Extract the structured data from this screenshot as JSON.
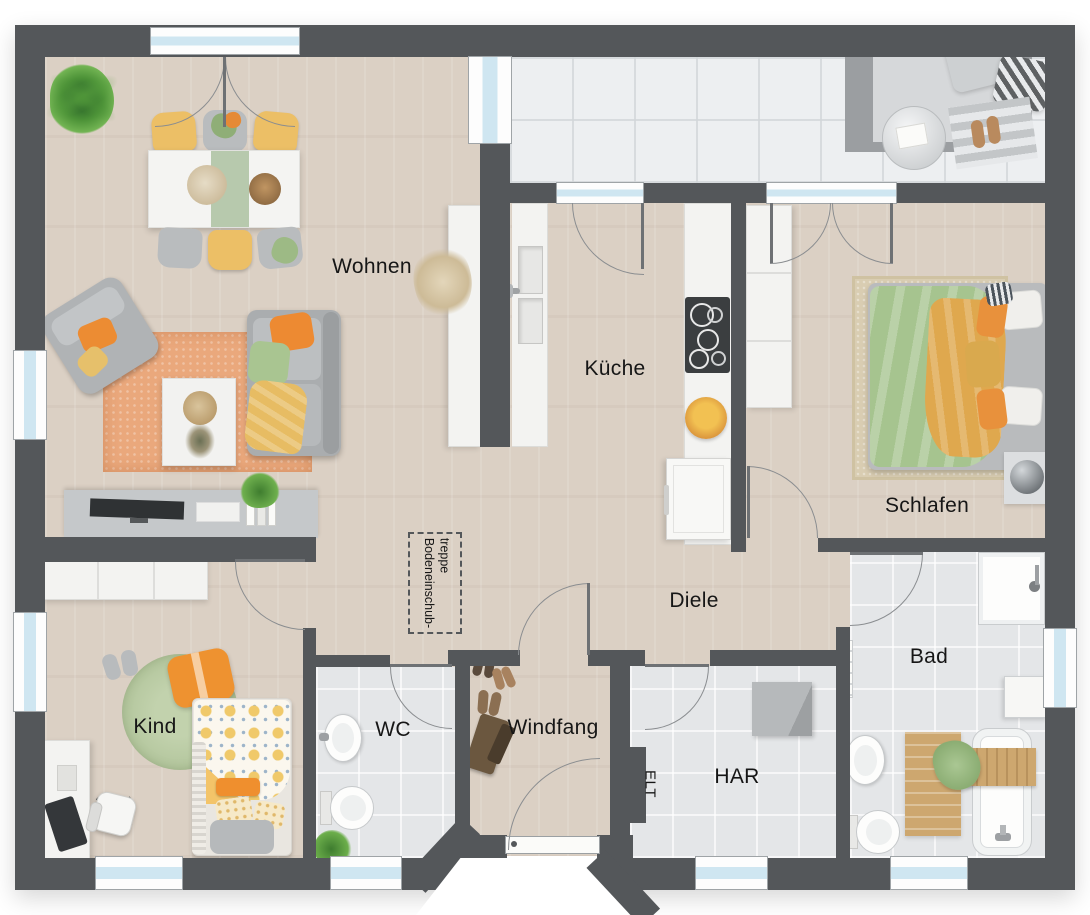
{
  "rooms": {
    "wohnen": "Wohnen",
    "kueche": "Küche",
    "schlafen": "Schlafen",
    "diele": "Diele",
    "kind": "Kind",
    "wc": "WC",
    "windfang": "Windfang",
    "har": "HAR",
    "bad": "Bad"
  },
  "annotations": {
    "electrical": "ELT",
    "attic_stairs_line1": "Bodeneinschub-",
    "attic_stairs_line2": "treppe"
  },
  "palette": {
    "wall": "#54575a",
    "wood_floor": "#dbd0c4",
    "tile_floor": "#e4e6e8",
    "terrace_floor": "#edeff1",
    "window_glass": "#cfe6f1",
    "accent_orange": "#ec8c33",
    "accent_yellow": "#ecbf66",
    "accent_green": "#a8c591",
    "rug_orange": "#eaa87c",
    "rug_green": "#b7c9a1"
  }
}
